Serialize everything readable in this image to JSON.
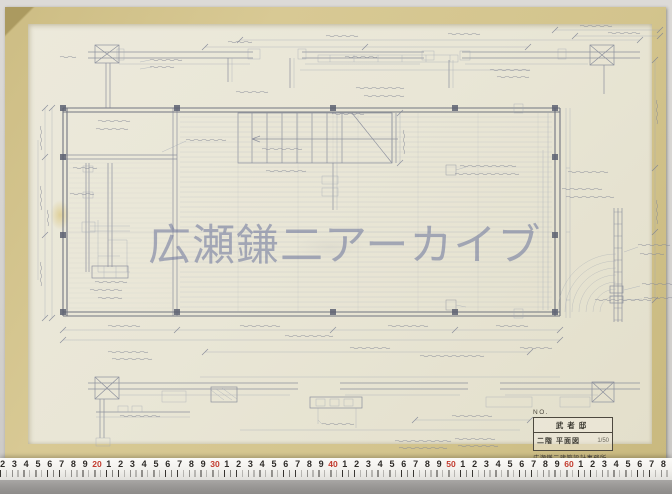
{
  "watermark": {
    "text": "広瀬鎌二アーカイブ"
  },
  "title_block": {
    "no_label": "NO.",
    "project": "武者邸",
    "drawing_title": "二階 平面図",
    "scale": "1/50",
    "office_stamp": "広瀬鎌二建築設計事務所"
  },
  "ruler": {
    "leading_digits": [
      "2",
      "3",
      "4",
      "5",
      "6",
      "7",
      "8",
      "9"
    ],
    "decade_labels": [
      "20",
      "30",
      "40",
      "50",
      "60"
    ],
    "decade_digits": [
      "1",
      "2",
      "3",
      "4",
      "5",
      "6",
      "7",
      "8",
      "9"
    ],
    "digit_color": "#2e2b28",
    "red_color": "#c23b2e"
  },
  "colors": {
    "paper": "#e9e6d6",
    "tape_border": "#d3c48d",
    "pencil": "#7d8294",
    "pencil_light": "#a2a8b4",
    "pencil_dark": "#5d6272",
    "watermark": "rgba(100,110,152,0.52)"
  }
}
